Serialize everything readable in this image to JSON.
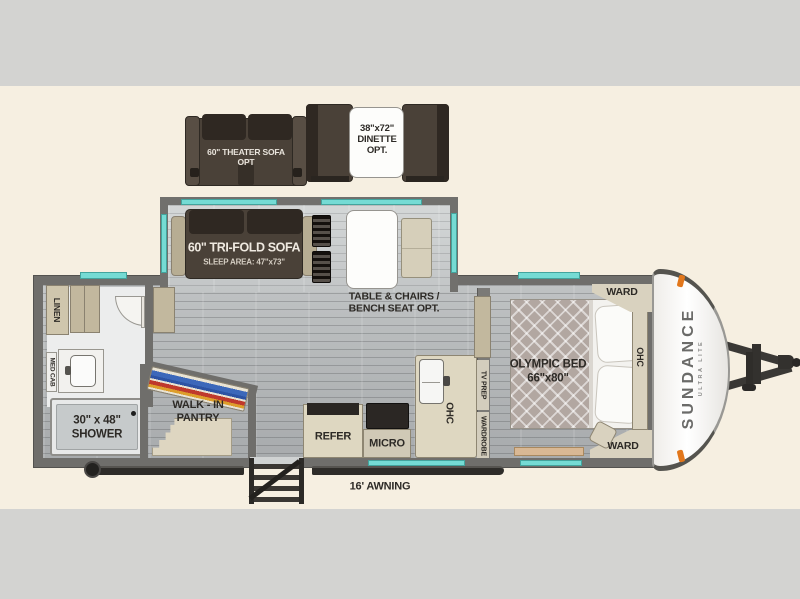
{
  "plan_title": "Travel trailer floorplan",
  "options": {
    "theater_sofa": {
      "line1": "60\" THEATER SOFA",
      "line2": "OPT"
    },
    "dinette": {
      "line1": "38\"x72\"",
      "line2": "DINETTE",
      "line3": "OPT."
    }
  },
  "slide": {
    "trifold": {
      "line1": "60\" TRI-FOLD SOFA",
      "line2": "SLEEP AREA: 47\"x73\""
    }
  },
  "main": {
    "table_chairs": {
      "line1": "TABLE & CHAIRS /",
      "line2": "BENCH SEAT OPT."
    },
    "linen": "LINEN",
    "med_cab": "MED CAB",
    "shower": {
      "line1": "30\" x 48\"",
      "line2": "SHOWER"
    },
    "pantry": {
      "line1": "WALK - IN",
      "line2": "PANTRY"
    },
    "refer": "REFER",
    "micro": "MICRO",
    "ohc_kitchen": "OHC",
    "tv_prep": "TV PREP",
    "wardrobe": "WARDROBE"
  },
  "bedroom": {
    "bed": {
      "line1": "OLYMPIC BED",
      "line2": "66\"x80\""
    },
    "ward_top": "WARD",
    "ward_bottom": "WARD",
    "ohc": "OHC"
  },
  "exterior": {
    "awning": "16' AWNING",
    "brand": "SUNDANCE",
    "brand_sub": "ULTRA LITE"
  },
  "colors": {
    "background_cream": "#f6efe1",
    "gray_band": "#d3d3d1",
    "wall_gray": "#6f6e6b",
    "window_teal": "#75dbd4",
    "sofa_brown": "#4a4138",
    "cabinet_cream": "#d9d2bf",
    "cabinet_tan": "#c2b89e",
    "clearance_orange": "#e2771c",
    "awning_black": "#2e2c29"
  }
}
